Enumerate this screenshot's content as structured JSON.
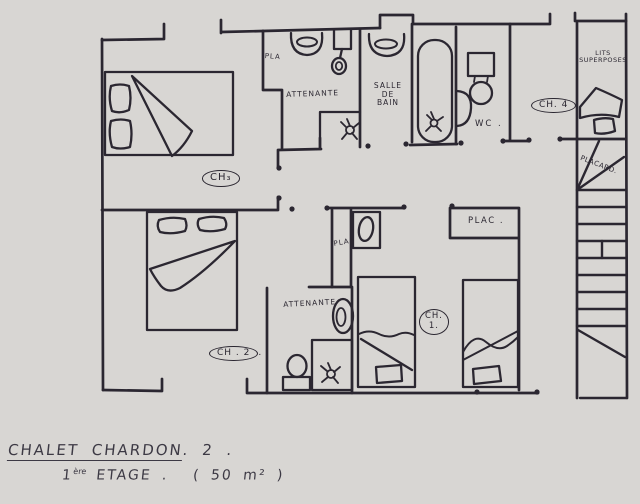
{
  "colors": {
    "paper": "#f7f5f3",
    "ink": "#2b2731",
    "pen_footer": "#3c3944"
  },
  "plan": {
    "closet_top": "PLA",
    "ensuite_top": "ATTENANTE",
    "bathroom": {
      "l1": "SALLE",
      "l2": "DE",
      "l3": "BAIN"
    },
    "wc": "WC .",
    "room4": "CH. 4",
    "bunks": {
      "l1": "LITS",
      "l2": "SUPERPOSES"
    },
    "stair_closet": "PLACARD.",
    "room3": "CH₃",
    "closet_mid": "PLA",
    "ensuite_bottom": "ATTENANTE",
    "room2": "CH . 2",
    "room2_after": ".",
    "room1": {
      "l1": "CH.",
      "l2": "1."
    },
    "closet_plac": "PLAC ."
  },
  "footer": {
    "title_main": "CHALET CHARDON",
    "title_suffix": ".  2 .",
    "floor_num": "1",
    "floor_sup": "ère",
    "floor_word": "ETAGE .",
    "area": "( 50 m² )"
  }
}
